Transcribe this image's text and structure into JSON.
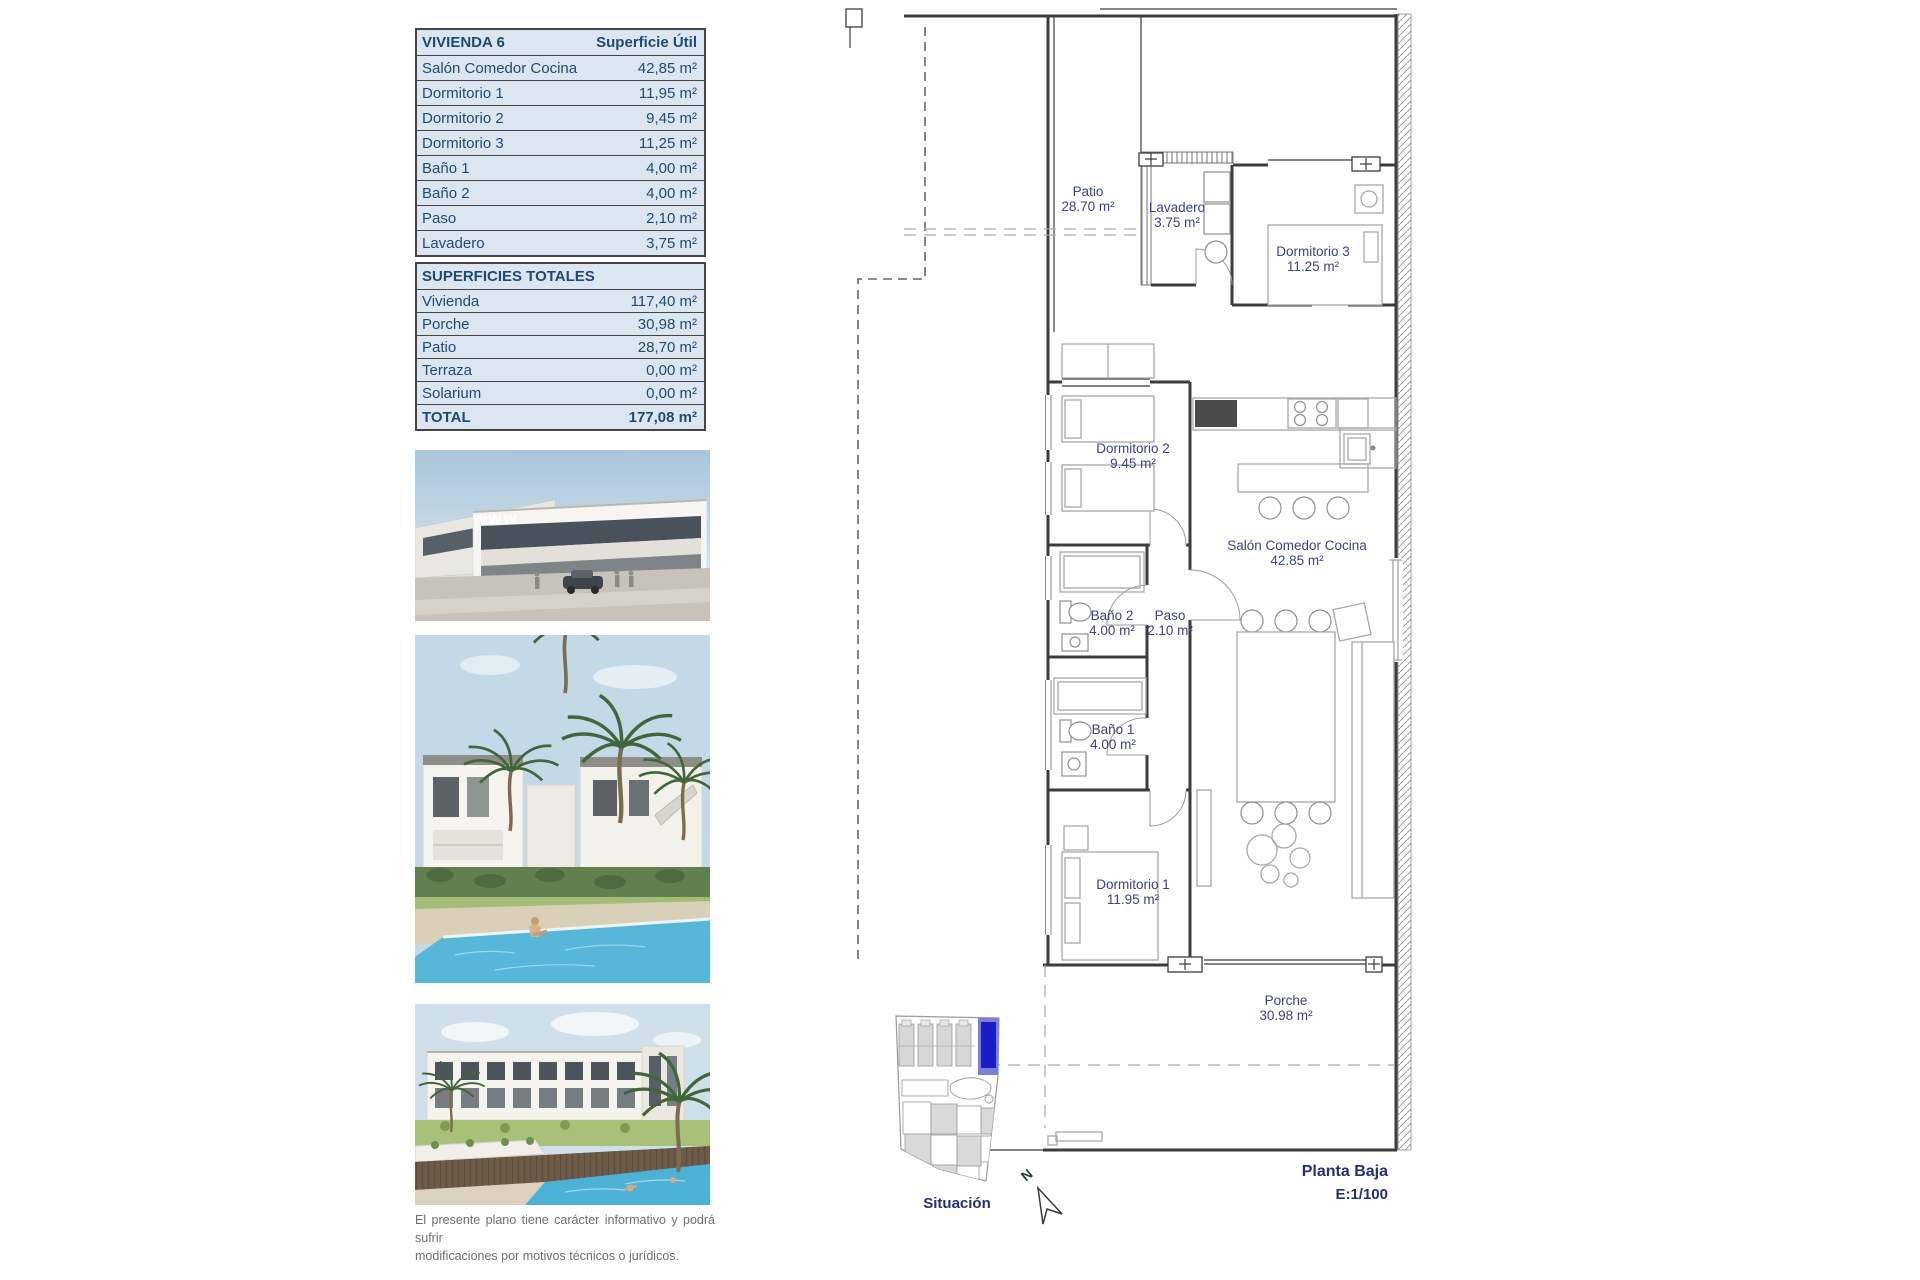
{
  "tables": {
    "vivienda": {
      "title": "VIVIENDA 6",
      "col_header": "Superficie Útil",
      "rows": [
        {
          "label": "Salón Comedor Cocina",
          "value": "42,85 m²"
        },
        {
          "label": "Dormitorio 1",
          "value": "11,95 m²"
        },
        {
          "label": "Dormitorio 2",
          "value": "9,45 m²"
        },
        {
          "label": "Dormitorio 3",
          "value": "11,25 m²"
        },
        {
          "label": "Baño 1",
          "value": "4,00 m²"
        },
        {
          "label": "Baño 2",
          "value": "4,00 m²"
        },
        {
          "label": "Paso",
          "value": "2,10 m²"
        },
        {
          "label": "Lavadero",
          "value": "3,75 m²"
        }
      ]
    },
    "totales": {
      "title": "SUPERFICIES TOTALES",
      "rows": [
        {
          "label": "Vivienda",
          "value": "117,40 m²"
        },
        {
          "label": "Porche",
          "value": "30,98 m²"
        },
        {
          "label": "Patio",
          "value": "28,70 m²"
        },
        {
          "label": "Terraza",
          "value": "0,00 m²"
        },
        {
          "label": "Solarium",
          "value": "0,00 m²"
        }
      ],
      "total": {
        "label": "TOTAL",
        "value": "177,08 m²"
      }
    }
  },
  "plan": {
    "rooms": {
      "patio": {
        "name": "Patio",
        "area": "28.70 m²"
      },
      "lavadero": {
        "name": "Lavadero",
        "area": "3.75 m²"
      },
      "dormitorio3": {
        "name": "Dormitorio 3",
        "area": "11.25 m²"
      },
      "dormitorio2": {
        "name": "Dormitorio 2",
        "area": "9.45 m²"
      },
      "salon": {
        "name": "Salón Comedor Cocina",
        "area": "42.85 m²"
      },
      "bano2": {
        "name": "Baño 2",
        "area": "4.00 m²"
      },
      "paso": {
        "name": "Paso",
        "area": "2.10 m²"
      },
      "bano1": {
        "name": "Baño 1",
        "area": "4.00 m²"
      },
      "dormitorio1": {
        "name": "Dormitorio 1",
        "area": "11.95 m²"
      },
      "porche": {
        "name": "Porche",
        "area": "30.98 m²"
      }
    },
    "title": "Planta Baja",
    "scale": "E:1/100",
    "north": "N"
  },
  "situacion": {
    "label": "Situación"
  },
  "photos": {
    "watermark": "www"
  },
  "disclaimer": {
    "line1": "El presente plano tiene carácter informativo y podrá sufrir",
    "line2": "modificaciones por motivos técnicos o jurídicos."
  },
  "colors": {
    "table_bg": "#dce6f1",
    "table_text": "#1f4a73",
    "plan_label": "#3b4380",
    "title_navy": "#27306e",
    "situacion_highlight": "#1c1cc6",
    "porche_green": "#cfe3cb",
    "pool_blue": "#57b7d9"
  }
}
